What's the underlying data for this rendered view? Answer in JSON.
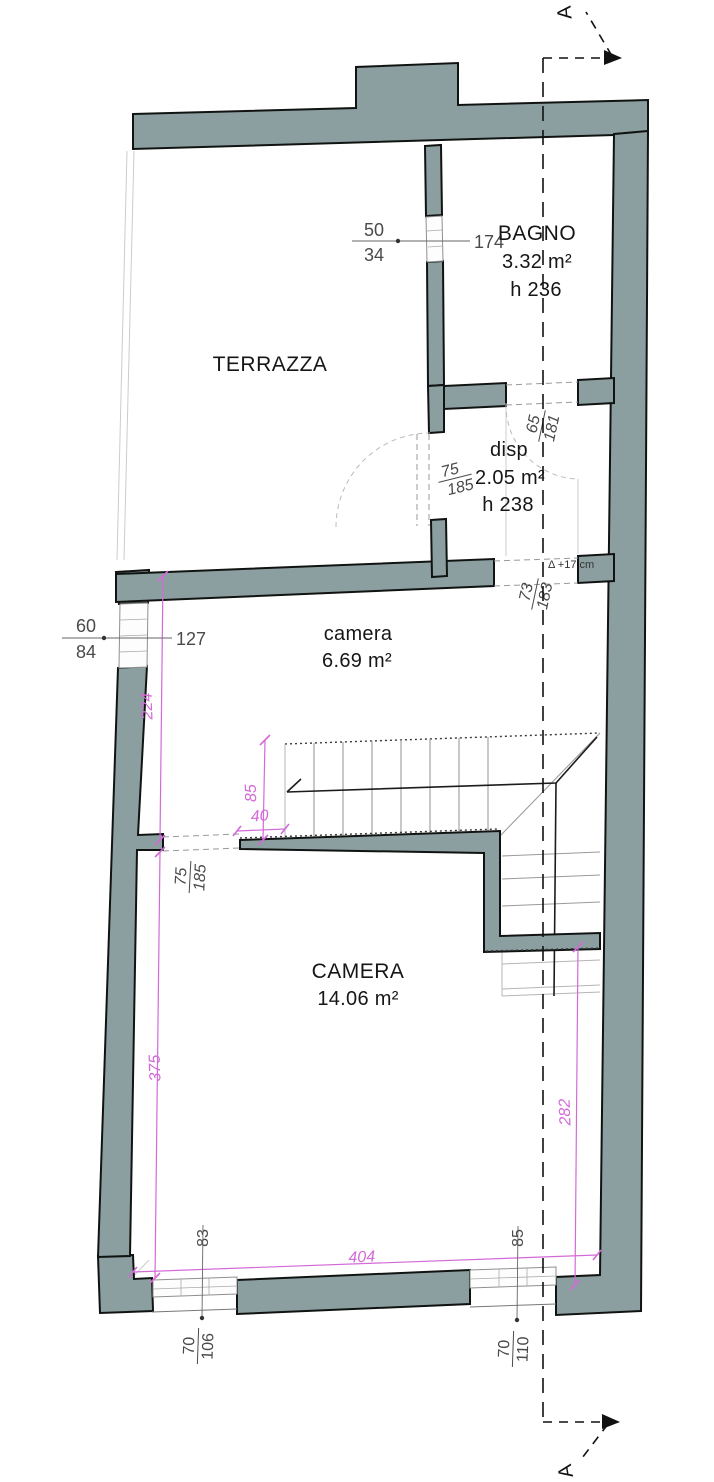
{
  "drawing": {
    "type": "floor-plan",
    "section_label": "A",
    "level_note": "Δ +17 cm"
  },
  "colors": {
    "wall": "#8c9fa0",
    "dim_accent": "#d36ad8",
    "line": "#111111"
  },
  "rooms": {
    "terrazza": {
      "name": "TERRAZZA"
    },
    "bagno": {
      "name": "BAGNO",
      "area": "3.32 m²",
      "height": "h 236"
    },
    "disp": {
      "name": "disp",
      "area": "2.05 m²",
      "height": "h 238"
    },
    "camera_small": {
      "name": "camera",
      "area": "6.69 m²"
    },
    "camera_big": {
      "name": "CAMERA",
      "area": "14.06 m²"
    }
  },
  "openings": {
    "bagno_window": {
      "width": "50",
      "sill": "34",
      "offset": "174"
    },
    "camera_window": {
      "width": "60",
      "sill": "84",
      "offset": "127"
    },
    "disp_door": {
      "width": "65",
      "height": "181"
    },
    "terrazza_door": {
      "width": "75",
      "height": "185"
    },
    "camera_door": {
      "width": "73",
      "height": "183"
    },
    "room_passage": {
      "width": "75",
      "height": "185"
    },
    "window_bottom_left": {
      "width": "70",
      "height": "106",
      "offset": "83"
    },
    "window_bottom_right": {
      "width": "70",
      "height": "110",
      "offset": "85"
    }
  },
  "dimensions": {
    "terrace_wall": "224",
    "stair_width": "85",
    "stair_offset": "40",
    "camera_left": "375",
    "camera_right": "282",
    "camera_width": "404"
  }
}
